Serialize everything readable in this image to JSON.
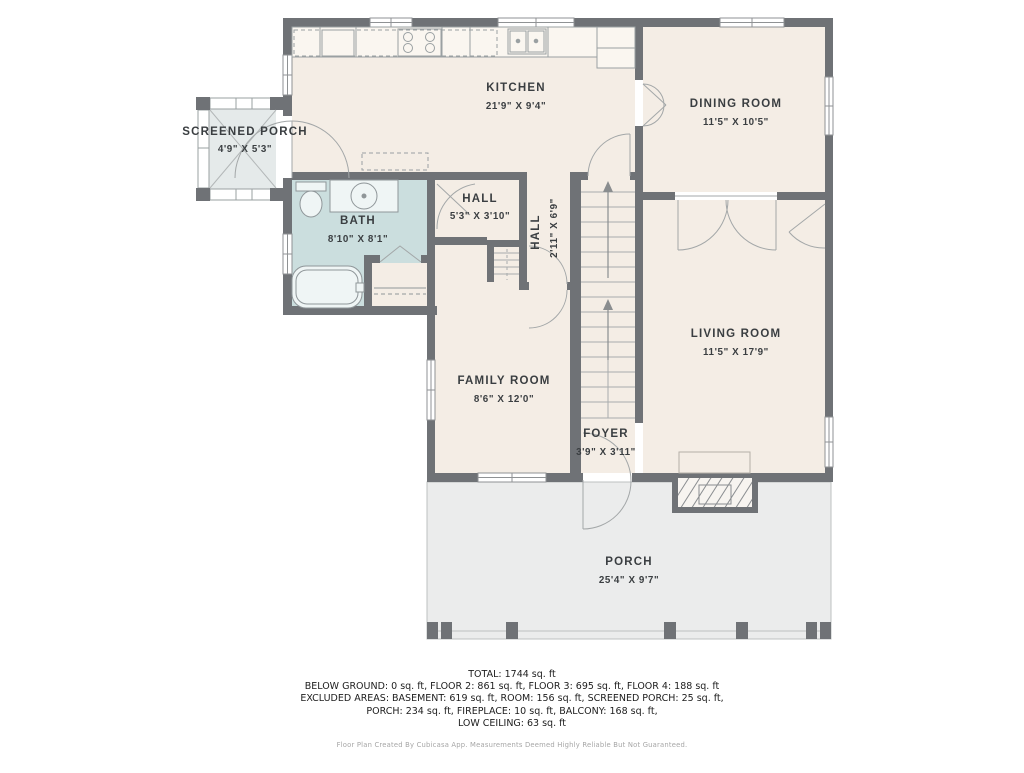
{
  "rooms": {
    "screened_porch": {
      "name": "SCREENED PORCH",
      "dims": "4'9\" X 5'3\""
    },
    "kitchen": {
      "name": "KITCHEN",
      "dims": "21'9\" X 9'4\""
    },
    "dining_room": {
      "name": "DINING ROOM",
      "dims": "11'5\" X 10'5\""
    },
    "bath": {
      "name": "BATH",
      "dims": "8'10\" X 8'1\""
    },
    "hall_upper": {
      "name": "HALL",
      "dims": "5'3\" X 3'10\""
    },
    "hall_lower": {
      "name": "HALL",
      "dims": "2'11\" X 6'9\""
    },
    "living_room": {
      "name": "LIVING ROOM",
      "dims": "11'5\" X 17'9\""
    },
    "family_room": {
      "name": "FAMILY ROOM",
      "dims": "8'6\" X 12'0\""
    },
    "foyer": {
      "name": "FOYER",
      "dims": "3'9\" X 3'11\""
    },
    "porch": {
      "name": "PORCH",
      "dims": "25'4\" X 9'7\""
    }
  },
  "summary": {
    "lines": [
      "TOTAL: 1744 sq. ft",
      "BELOW GROUND: 0 sq. ft, FLOOR 2: 861 sq. ft, FLOOR 3: 695 sq. ft, FLOOR 4: 188 sq. ft",
      "EXCLUDED AREAS: BASEMENT: 619 sq. ft, ROOM: 156 sq. ft, SCREENED PORCH: 25 sq. ft,",
      "PORCH: 234 sq. ft, FIREPLACE: 10 sq. ft, BALCONY: 168 sq. ft,",
      "LOW CEILING: 63 sq. ft"
    ]
  },
  "footer": "Floor Plan Created By Cubicasa App. Measurements Deemed Highly Reliable But Not Guaranteed.",
  "colors": {
    "wall": "#6f7276",
    "room_fill": "#f4ede5",
    "bath_fill": "#cbdede",
    "screened_porch_fill": "#e5eaea",
    "porch_fill": "#ebecec",
    "fixture_line": "#9aa0a2",
    "door_arc": "#a3a7a8",
    "label_text": "#3a3e41"
  }
}
